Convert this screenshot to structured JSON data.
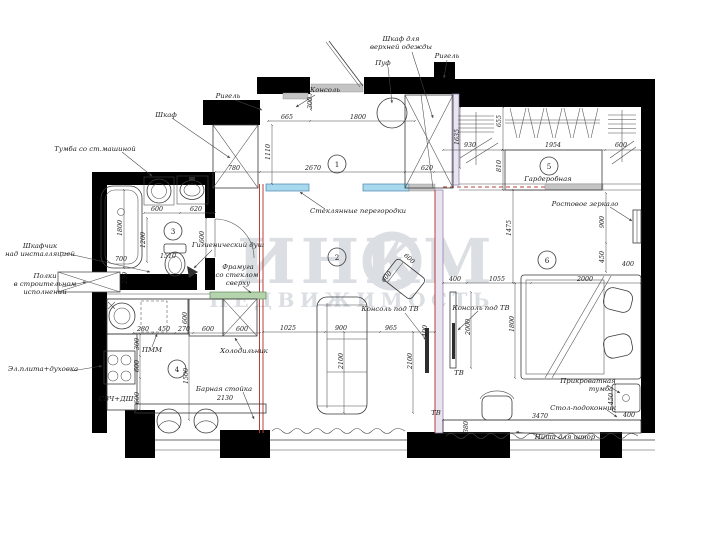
{
  "drawing": {
    "type": "apartment floor plan",
    "watermark": {
      "brand_left": "ИНК",
      "brand_right": "М",
      "subtitle": "НЕДВИЖИМОСТЬ"
    },
    "colors": {
      "glass_partition": "#a8d8ee",
      "transom_glass": "#b5d4ad",
      "new_partition": "#b5403c",
      "watermark": "#bfc4cc"
    },
    "rooms": [
      "1",
      "2",
      "3",
      "4",
      "5",
      "6"
    ],
    "labels": [
      "Шкаф для",
      "верхней одежды",
      "Пуф",
      "Ригель",
      "Ригель",
      "Консоль",
      "Шкаф",
      "Тумба со ст.машиной",
      "Шкафчик",
      "над инсталляцией",
      "Полки",
      "в строительном",
      "исполнении",
      "Гигиенический душ",
      "Фрамуга",
      "со стеклом",
      "сверху",
      "Стеклянные перегородки",
      "Гардеробная",
      "Ростовое зеркало",
      "Эл.плита+духовка",
      "СВЧ+ДШ",
      "ПММ",
      "Холодильник",
      "Барная стойка",
      "Консоль под ТВ",
      "Консоль под ТВ",
      "ТВ",
      "ТВ",
      "Прикроватная",
      "тумба",
      "Стол-подоконник",
      "Ниша для штор"
    ],
    "dims": [
      "665",
      "1800",
      "300",
      "2670",
      "1110",
      "780",
      "620",
      "1635",
      "600",
      "620",
      "1800",
      "1200",
      "700",
      "1510",
      "600",
      "230",
      "280",
      "450",
      "270",
      "600",
      "600",
      "300",
      "600",
      "600",
      "1500",
      "600",
      "2130",
      "1025",
      "900",
      "965",
      "2100",
      "2100",
      "600",
      "600",
      "400",
      "1055",
      "2000",
      "1800",
      "2000",
      "1475",
      "930",
      "1954",
      "600",
      "810",
      "655",
      "900",
      "450",
      "400",
      "450",
      "400",
      "3470",
      "380",
      "400"
    ]
  }
}
